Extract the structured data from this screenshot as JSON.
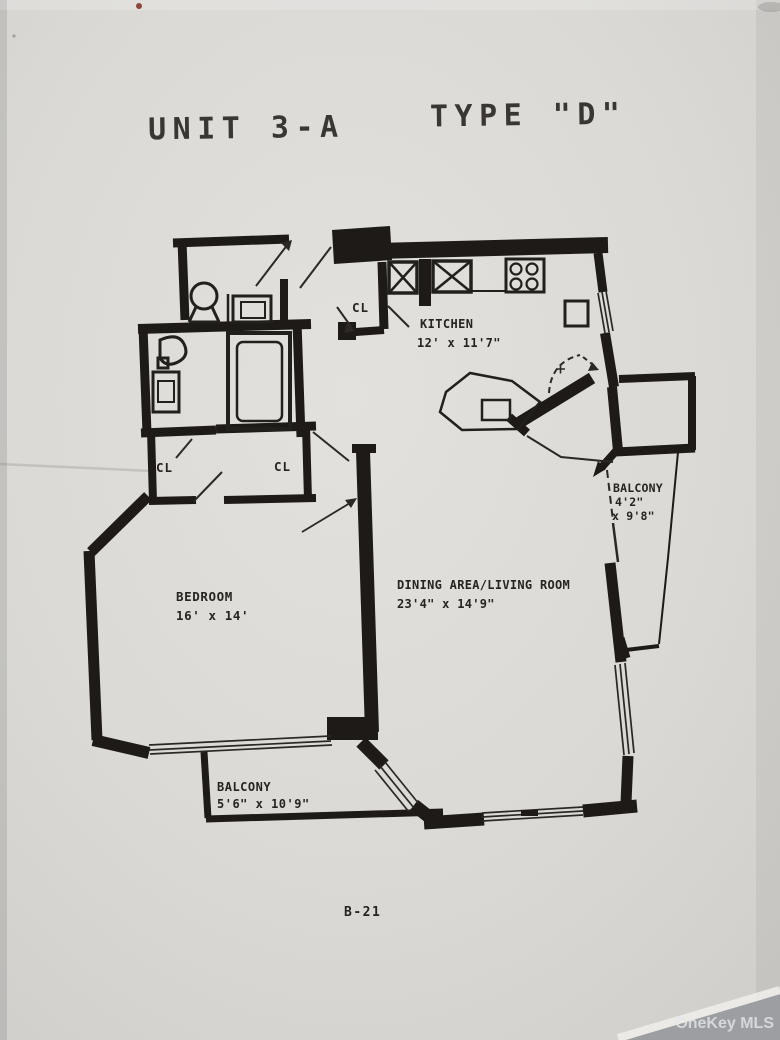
{
  "title": {
    "unit": "UNIT 3-A",
    "type": "TYPE \"D\""
  },
  "rooms": {
    "kitchen": {
      "name": "KITCHEN",
      "dims": "12' x 11'7\""
    },
    "dining_living": {
      "name": "DINING AREA/LIVING ROOM",
      "dims": "23'4\" x 14'9\""
    },
    "bedroom": {
      "name": "BEDROOM",
      "dims": "16' x 14'"
    },
    "balcony_right": {
      "name": "BALCONY",
      "dims_line1": "4'2\"",
      "dims_line2": "x 9'8\""
    },
    "balcony_bottom": {
      "name": "BALCONY",
      "dims": "5'6\" x 10'9\""
    }
  },
  "closets": {
    "entry": "CL",
    "hall_left": "CL",
    "hall_right": "CL"
  },
  "drawing_number": "B-21",
  "watermark": "OneKey MLS"
}
